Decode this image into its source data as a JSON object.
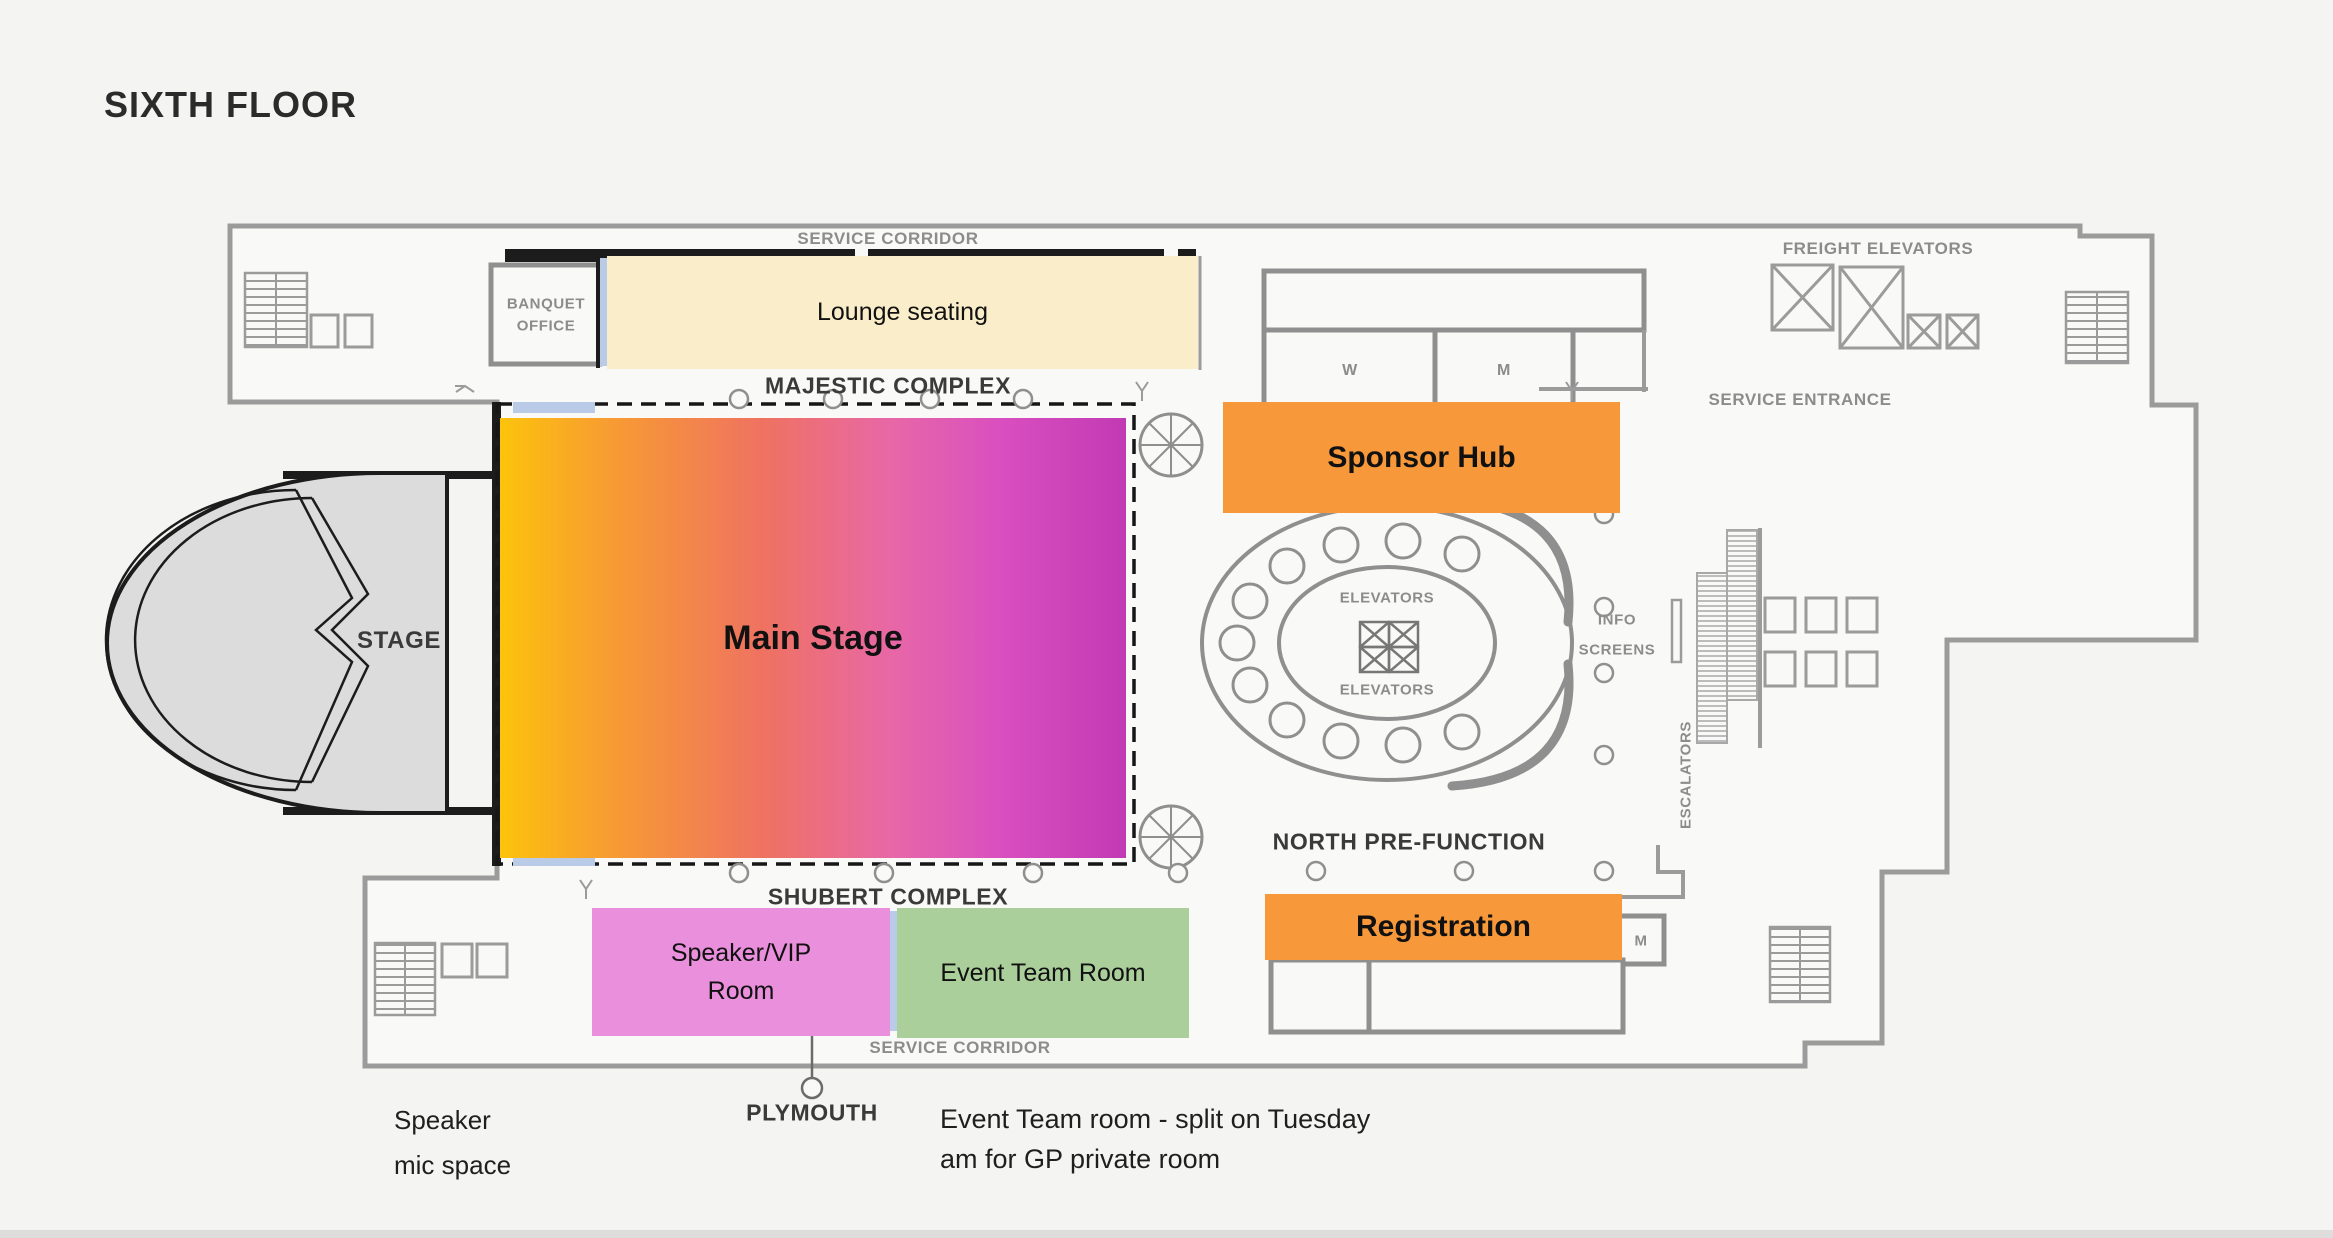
{
  "title": "SIXTH FLOOR",
  "plan": {
    "corridors": {
      "service_corridor_top": "SERVICE CORRIDOR",
      "service_corridor_bottom": "SERVICE CORRIDOR",
      "majestic_complex": "MAJESTIC COMPLEX",
      "shubert_complex": "SHUBERT COMPLEX",
      "north_pre_function": "NORTH PRE-FUNCTION",
      "plymouth": "PLYMOUTH",
      "service_entrance": "SERVICE ENTRANCE",
      "freight_elevators": "FREIGHT ELEVATORS"
    },
    "rooms": {
      "stage": "STAGE",
      "banquet_office_line1": "BANQUET",
      "banquet_office_line2": "OFFICE",
      "restroom_w": "W",
      "restroom_m": "M",
      "room_m_south": "M",
      "elevators_top": "ELEVATORS",
      "elevators_bottom": "ELEVATORS",
      "info_screens_line1": "INFO",
      "info_screens_line2": "SCREENS",
      "escalators": "ESCALATORS"
    }
  },
  "overlays": {
    "lounge": {
      "label": "Lounge seating",
      "color": "#faeeca"
    },
    "sponsor_hub": {
      "label": "Sponsor Hub",
      "color": "#f7993b"
    },
    "main_stage": {
      "label": "Main Stage",
      "gradient": "linear-gradient(90deg,#fcc30c 0%,#f79b33 18%,#ef7261 42%,#e868a6 62%,#d94fc0 80%,#c23ab3 100%)"
    },
    "speaker_vip": {
      "label_line1": "Speaker/VIP",
      "label_line2": "Room",
      "color": "#e98fdb"
    },
    "event_team": {
      "label": "Event Team Room",
      "color": "#abcf9b"
    },
    "registration": {
      "label": "Registration",
      "color": "#f7993b"
    }
  },
  "annotations": {
    "speaker_mic_line1": "Speaker",
    "speaker_mic_line2": "mic space",
    "event_team_note_line1": "Event Team room - split on Tuesday",
    "event_team_note_line2": "am for GP private room"
  }
}
